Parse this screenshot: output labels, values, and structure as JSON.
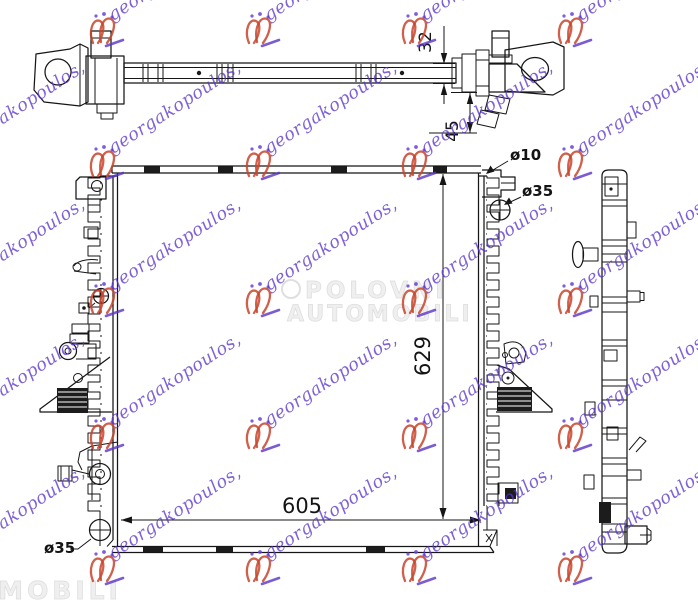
{
  "watermarks": {
    "seller": {
      "text": "georgakopoulos,",
      "text_color": "#5b36c9",
      "crest_color": "#c8442c",
      "accent_color": "#6a3fd8"
    },
    "marketplace": {
      "line1": "POLOVNI",
      "line2": "AUTOMOBILI",
      "corner_fragment": "AUTOMOBILI",
      "color": "#e9e9e9"
    }
  },
  "drawing": {
    "background": "#ffffff",
    "line_color": "#161616",
    "dimensions": {
      "core_width": "605",
      "core_height": "629",
      "bracket_bar_height": "32",
      "bracket_drop": "45",
      "bleed_hole": "ø10",
      "filler_neck": "ø35",
      "drain_plug": "ø35"
    }
  }
}
